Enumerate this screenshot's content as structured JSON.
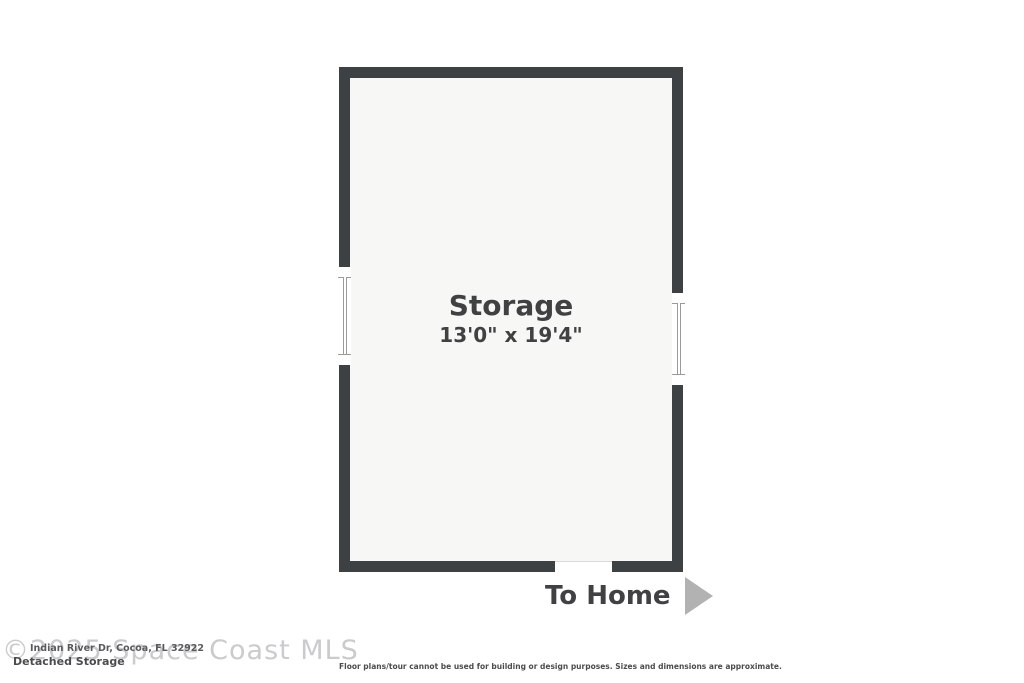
{
  "floorplan": {
    "room": {
      "name": "Storage",
      "dimensions": "13'0\" x 19'4\""
    },
    "direction_label": "To Home",
    "features": [
      "window-left-wall",
      "window-right-wall",
      "door-opening-bottom-wall"
    ]
  },
  "footer": {
    "watermark": "©2025 Space Coast MLS",
    "address": "Indian River Dr, Cocoa, FL 32922",
    "plan_title": "Detached Storage",
    "disclaimer": "Floor plans/tour cannot be used for building or design purposes. Sizes and dimensions are approximate."
  },
  "colors": {
    "wall": "#3e4144",
    "floor": "#f7f7f6",
    "text": "#3f4143",
    "arrow": "#b2b2b2",
    "watermark": "#c9cbcc"
  }
}
